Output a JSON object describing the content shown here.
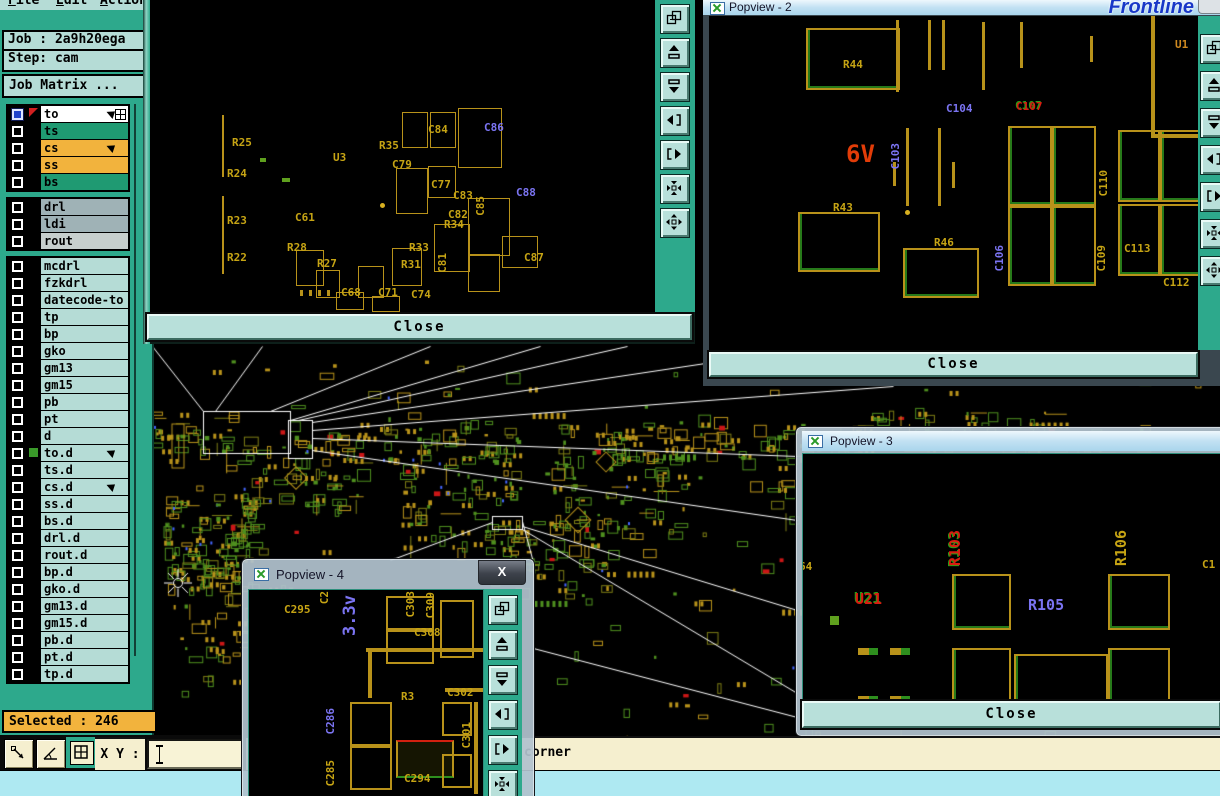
{
  "logo_text": "Frontline",
  "menu": {
    "items": [
      {
        "label": "File"
      },
      {
        "label": "Edit"
      },
      {
        "label": "Action"
      }
    ]
  },
  "job_panel": {
    "job": "Job : 2a9h20ega",
    "step": "Step: cam"
  },
  "matrix": {
    "title": "Job Matrix ..."
  },
  "selected": {
    "label": "Selected : 246"
  },
  "coord_bar": {
    "xy_label": "X Y :",
    "xy_value": "",
    "buttons": [
      "measure-distance",
      "measure-angle",
      "quad-view"
    ]
  },
  "status": {
    "message": "corner"
  },
  "colors": {
    "sidebar": "#2da98c",
    "panel": "#b5dcd6",
    "orange": "#f2b33d",
    "green_row": "#1f9a72",
    "gray_row": "#9fb2b6",
    "gray_row_light": "#c7cfcd",
    "white_row": "#ffffff",
    "pcb_yellow": "#b8921a",
    "pcb_green": "#4e8f1e",
    "pcb_red": "#cc1616",
    "label_blue": "#7b74f2",
    "close_btn": "#b8e0da",
    "status_cream": "#f5efcf",
    "status_cyan": "#aee9f2"
  },
  "layers": [
    {
      "name": "to",
      "bg": "#ffffff",
      "lead": "blue",
      "icons": [
        "hand",
        "grid"
      ]
    },
    {
      "name": "ts",
      "bg": "#1f9a72"
    },
    {
      "name": "cs",
      "bg": "#f2b33d",
      "icons": [
        "hand"
      ]
    },
    {
      "name": "ss",
      "bg": "#f2b33d"
    },
    {
      "name": "bs",
      "bg": "#1f9a72",
      "gapAfter": true
    },
    {
      "name": "drl",
      "bg": "#9fb2b6"
    },
    {
      "name": "ldi",
      "bg": "#9fb2b6"
    },
    {
      "name": "rout",
      "bg": "#c7cfcd",
      "gapAfter": true
    },
    {
      "name": "mcdrl",
      "bg": "#b5dcd6"
    },
    {
      "name": "fzkdrl",
      "bg": "#b5dcd6"
    },
    {
      "name": "datecode-to",
      "bg": "#b5dcd6"
    },
    {
      "name": "tp",
      "bg": "#b5dcd6"
    },
    {
      "name": "bp",
      "bg": "#b5dcd6"
    },
    {
      "name": "gko",
      "bg": "#b5dcd6"
    },
    {
      "name": "gm13",
      "bg": "#b5dcd6"
    },
    {
      "name": "gm15",
      "bg": "#b5dcd6"
    },
    {
      "name": "pb",
      "bg": "#b5dcd6"
    },
    {
      "name": "pt",
      "bg": "#b5dcd6"
    },
    {
      "name": "d",
      "bg": "#b5dcd6"
    },
    {
      "name": "to.d",
      "bg": "#b5dcd6",
      "marker": true,
      "icons": [
        "hand"
      ]
    },
    {
      "name": "ts.d",
      "bg": "#b5dcd6"
    },
    {
      "name": "cs.d",
      "bg": "#b5dcd6",
      "icons": [
        "hand"
      ]
    },
    {
      "name": "ss.d",
      "bg": "#b5dcd6"
    },
    {
      "name": "bs.d",
      "bg": "#b5dcd6"
    },
    {
      "name": "drl.d",
      "bg": "#b5dcd6"
    },
    {
      "name": "rout.d",
      "bg": "#b5dcd6"
    },
    {
      "name": "bp.d",
      "bg": "#b5dcd6"
    },
    {
      "name": "gko.d",
      "bg": "#b5dcd6"
    },
    {
      "name": "gm13.d",
      "bg": "#b5dcd6"
    },
    {
      "name": "gm15.d",
      "bg": "#b5dcd6"
    },
    {
      "name": "pb.d",
      "bg": "#b5dcd6"
    },
    {
      "name": "pt.d",
      "bg": "#b5dcd6"
    },
    {
      "name": "tp.d",
      "bg": "#b5dcd6"
    }
  ],
  "popviews": [
    {
      "id": "popview-1",
      "title": "",
      "close_label": "Close",
      "toolbar": [
        "copy-window",
        "pan-up",
        "pan-down",
        "pan-left",
        "pan-right",
        "zoom-contract",
        "zoom-expand"
      ],
      "labels": [
        {
          "t": "R25",
          "x": 232,
          "y": 136
        },
        {
          "t": "R24",
          "x": 227,
          "y": 167
        },
        {
          "t": "R23",
          "x": 227,
          "y": 214
        },
        {
          "t": "R22",
          "x": 227,
          "y": 251
        },
        {
          "t": "R28",
          "x": 287,
          "y": 241
        },
        {
          "t": "R27",
          "x": 317,
          "y": 257
        },
        {
          "t": "C61",
          "x": 295,
          "y": 211
        },
        {
          "t": "C68",
          "x": 341,
          "y": 286
        },
        {
          "t": "U3",
          "x": 333,
          "y": 151
        },
        {
          "t": "R35",
          "x": 379,
          "y": 139
        },
        {
          "t": "C84",
          "x": 428,
          "y": 123
        },
        {
          "t": "C86",
          "x": 484,
          "y": 121,
          "c": "b"
        },
        {
          "t": "C79",
          "x": 392,
          "y": 158
        },
        {
          "t": "C77",
          "x": 431,
          "y": 178
        },
        {
          "t": "C83",
          "x": 453,
          "y": 189
        },
        {
          "t": "C85",
          "x": 474,
          "y": 196,
          "v": true
        },
        {
          "t": "C88",
          "x": 516,
          "y": 186,
          "c": "b"
        },
        {
          "t": "C82",
          "x": 448,
          "y": 208
        },
        {
          "t": "R34",
          "x": 444,
          "y": 218
        },
        {
          "t": "R33",
          "x": 409,
          "y": 241
        },
        {
          "t": "C81",
          "x": 436,
          "y": 253,
          "v": true
        },
        {
          "t": "R31",
          "x": 401,
          "y": 258
        },
        {
          "t": "C71",
          "x": 378,
          "y": 286
        },
        {
          "t": "C74",
          "x": 411,
          "y": 288
        },
        {
          "t": "C87",
          "x": 524,
          "y": 251
        }
      ],
      "shapes": [
        [
          222,
          115,
          2,
          62,
          "vb"
        ],
        [
          222,
          196,
          2,
          78,
          "vb"
        ],
        [
          402,
          112,
          24,
          34,
          "o"
        ],
        [
          430,
          112,
          24,
          34,
          "o"
        ],
        [
          458,
          108,
          42,
          58,
          "o"
        ],
        [
          396,
          168,
          30,
          44,
          "o"
        ],
        [
          428,
          166,
          26,
          30,
          "o"
        ],
        [
          468,
          198,
          40,
          56,
          "o"
        ],
        [
          434,
          224,
          34,
          46,
          "o"
        ],
        [
          468,
          254,
          30,
          36,
          "o"
        ],
        [
          502,
          236,
          34,
          30,
          "o"
        ],
        [
          392,
          248,
          28,
          36,
          "o"
        ],
        [
          358,
          266,
          24,
          30,
          "o"
        ],
        [
          296,
          250,
          26,
          34,
          "o"
        ],
        [
          316,
          270,
          22,
          26,
          "o"
        ],
        [
          336,
          292,
          26,
          16,
          "o"
        ],
        [
          372,
          296,
          26,
          14,
          "o"
        ],
        [
          380,
          203,
          5,
          5,
          "dot"
        ],
        [
          300,
          290,
          3,
          6,
          "vb"
        ],
        [
          309,
          290,
          3,
          6,
          "vb"
        ],
        [
          318,
          290,
          3,
          6,
          "vb"
        ],
        [
          327,
          290,
          3,
          6,
          "vb"
        ],
        [
          282,
          178,
          8,
          4,
          "gfill"
        ],
        [
          260,
          158,
          6,
          4,
          "gfill"
        ]
      ]
    },
    {
      "id": "popview-2",
      "title": "Popview - 2",
      "close_label": "Close",
      "toolbar": [
        "copy-window",
        "pan-up",
        "pan-down",
        "pan-left",
        "pan-right",
        "zoom-contract",
        "zoom-expand"
      ],
      "labels": [
        {
          "t": "R44",
          "x": 843,
          "y": 58
        },
        {
          "t": "C104",
          "x": 946,
          "y": 102,
          "c": "b"
        },
        {
          "t": "C107",
          "x": 1016,
          "y": 100,
          "c": "rg"
        },
        {
          "t": "6V",
          "x": 846,
          "y": 140,
          "c": "r",
          "s": 24
        },
        {
          "t": "C103",
          "x": 889,
          "y": 143,
          "c": "b",
          "v": true
        },
        {
          "t": "R43",
          "x": 833,
          "y": 201
        },
        {
          "t": "R46",
          "x": 934,
          "y": 236
        },
        {
          "t": "C106",
          "x": 993,
          "y": 245,
          "c": "b",
          "v": true
        },
        {
          "t": "C110",
          "x": 1097,
          "y": 170,
          "v": true
        },
        {
          "t": "C109",
          "x": 1095,
          "y": 245,
          "v": true
        },
        {
          "t": "C113",
          "x": 1124,
          "y": 242
        },
        {
          "t": "C112",
          "x": 1163,
          "y": 276
        },
        {
          "t": "U1",
          "x": 1175,
          "y": 38,
          "c": "o"
        }
      ],
      "shapes": [
        [
          806,
          28,
          90,
          58,
          "og"
        ],
        [
          896,
          20,
          3,
          72,
          "vb"
        ],
        [
          928,
          20,
          3,
          50,
          "vb"
        ],
        [
          942,
          20,
          3,
          50,
          "vb"
        ],
        [
          982,
          22,
          3,
          68,
          "vb"
        ],
        [
          1020,
          22,
          3,
          46,
          "vb"
        ],
        [
          1090,
          36,
          3,
          26,
          "vb"
        ],
        [
          906,
          128,
          3,
          78,
          "vb"
        ],
        [
          938,
          128,
          3,
          78,
          "vb"
        ],
        [
          952,
          162,
          3,
          26,
          "vb"
        ],
        [
          893,
          162,
          3,
          24,
          "vb"
        ],
        [
          905,
          210,
          5,
          5,
          "dot"
        ],
        [
          798,
          212,
          78,
          56,
          "og"
        ],
        [
          903,
          248,
          72,
          46,
          "og"
        ],
        [
          1008,
          126,
          40,
          76,
          "og"
        ],
        [
          1052,
          126,
          40,
          76,
          "og"
        ],
        [
          1008,
          206,
          40,
          76,
          "og"
        ],
        [
          1052,
          206,
          40,
          76,
          "og"
        ],
        [
          1118,
          130,
          38,
          68,
          "og"
        ],
        [
          1160,
          130,
          38,
          68,
          "og"
        ],
        [
          1118,
          204,
          38,
          68,
          "og"
        ],
        [
          1160,
          204,
          38,
          68,
          "og"
        ],
        [
          1151,
          16,
          4,
          120,
          "vb"
        ],
        [
          1151,
          134,
          70,
          4,
          "hb"
        ]
      ]
    },
    {
      "id": "popview-3",
      "title": "Popview - 3",
      "close_label": "Close",
      "toolbar": [],
      "labels": [
        {
          "t": "64",
          "x": 797,
          "y": 558
        },
        {
          "t": "U21",
          "x": 853,
          "y": 588,
          "c": "rg",
          "s": 15
        },
        {
          "t": "R103",
          "x": 944,
          "y": 528,
          "c": "rg",
          "v": true,
          "s": 15
        },
        {
          "t": "R105",
          "x": 1026,
          "y": 594,
          "c": "b",
          "s": 15
        },
        {
          "t": "R106",
          "x": 1110,
          "y": 528,
          "v": true,
          "s": 15
        },
        {
          "t": "C1",
          "x": 1200,
          "y": 556
        }
      ],
      "shapes": [
        [
          950,
          572,
          55,
          52,
          "og"
        ],
        [
          950,
          646,
          55,
          55,
          "og"
        ],
        [
          1012,
          652,
          90,
          54,
          "ogr"
        ],
        [
          1106,
          572,
          58,
          52,
          "og"
        ],
        [
          1106,
          646,
          58,
          52,
          "og"
        ],
        [
          856,
          646,
          20,
          7,
          "hb2"
        ],
        [
          888,
          646,
          20,
          7,
          "hb2"
        ],
        [
          856,
          694,
          20,
          7,
          "hb2"
        ],
        [
          888,
          694,
          20,
          7,
          "hb2"
        ],
        [
          828,
          614,
          9,
          9,
          "gfill"
        ]
      ]
    },
    {
      "id": "popview-4",
      "title": "Popview - 4",
      "close_glyph": "X",
      "toolbar": [
        "copy-window",
        "pan-up",
        "pan-down",
        "pan-left",
        "pan-right",
        "zoom-contract"
      ],
      "labels": [
        {
          "t": "C2",
          "x": 316,
          "y": 589,
          "v": true
        },
        {
          "t": "C295",
          "x": 282,
          "y": 601
        },
        {
          "t": "C303",
          "x": 402,
          "y": 589,
          "v": true
        },
        {
          "t": "C309",
          "x": 422,
          "y": 590,
          "v": true
        },
        {
          "t": "C308",
          "x": 412,
          "y": 624
        },
        {
          "t": "3.3v",
          "x": 338,
          "y": 593,
          "c": "b",
          "v": true,
          "s": 17
        },
        {
          "t": "R3",
          "x": 399,
          "y": 688
        },
        {
          "t": "C302",
          "x": 445,
          "y": 684
        },
        {
          "t": "C286",
          "x": 322,
          "y": 706,
          "c": "b",
          "v": true
        },
        {
          "t": "C301",
          "x": 458,
          "y": 720,
          "v": true
        },
        {
          "t": "C285",
          "x": 322,
          "y": 758,
          "v": true
        },
        {
          "t": "C294",
          "x": 402,
          "y": 770
        }
      ],
      "shapes": [
        [
          384,
          594,
          44,
          30,
          "o"
        ],
        [
          384,
          628,
          44,
          30,
          "o"
        ],
        [
          438,
          598,
          30,
          54,
          "o"
        ],
        [
          364,
          646,
          122,
          4,
          "hb"
        ],
        [
          366,
          650,
          4,
          46,
          "vb"
        ],
        [
          443,
          686,
          42,
          4,
          "hb"
        ],
        [
          348,
          700,
          38,
          40,
          "o"
        ],
        [
          348,
          744,
          38,
          40,
          "o"
        ],
        [
          394,
          738,
          54,
          34,
          "frg"
        ],
        [
          440,
          700,
          26,
          30,
          "o"
        ],
        [
          440,
          752,
          26,
          30,
          "o"
        ],
        [
          472,
          700,
          4,
          92,
          "vb"
        ]
      ]
    }
  ],
  "callouts": {
    "rects": [
      [
        203,
        411,
        87,
        42
      ],
      [
        288,
        420,
        24,
        38
      ],
      [
        492,
        516,
        30,
        13
      ]
    ],
    "lines": [
      [
        203,
        411,
        152,
        346
      ],
      [
        215,
        411,
        262,
        346
      ],
      [
        270,
        411,
        430,
        346
      ],
      [
        290,
        420,
        540,
        346
      ],
      [
        298,
        420,
        627,
        346
      ],
      [
        312,
        422,
        705,
        363
      ],
      [
        312,
        430,
        893,
        386
      ],
      [
        312,
        438,
        797,
        456
      ],
      [
        312,
        450,
        797,
        520
      ],
      [
        492,
        522,
        390,
        560
      ],
      [
        522,
        521,
        533,
        562
      ],
      [
        522,
        526,
        797,
        610
      ],
      [
        522,
        529,
        797,
        693
      ],
      [
        533,
        648,
        797,
        717
      ]
    ]
  }
}
